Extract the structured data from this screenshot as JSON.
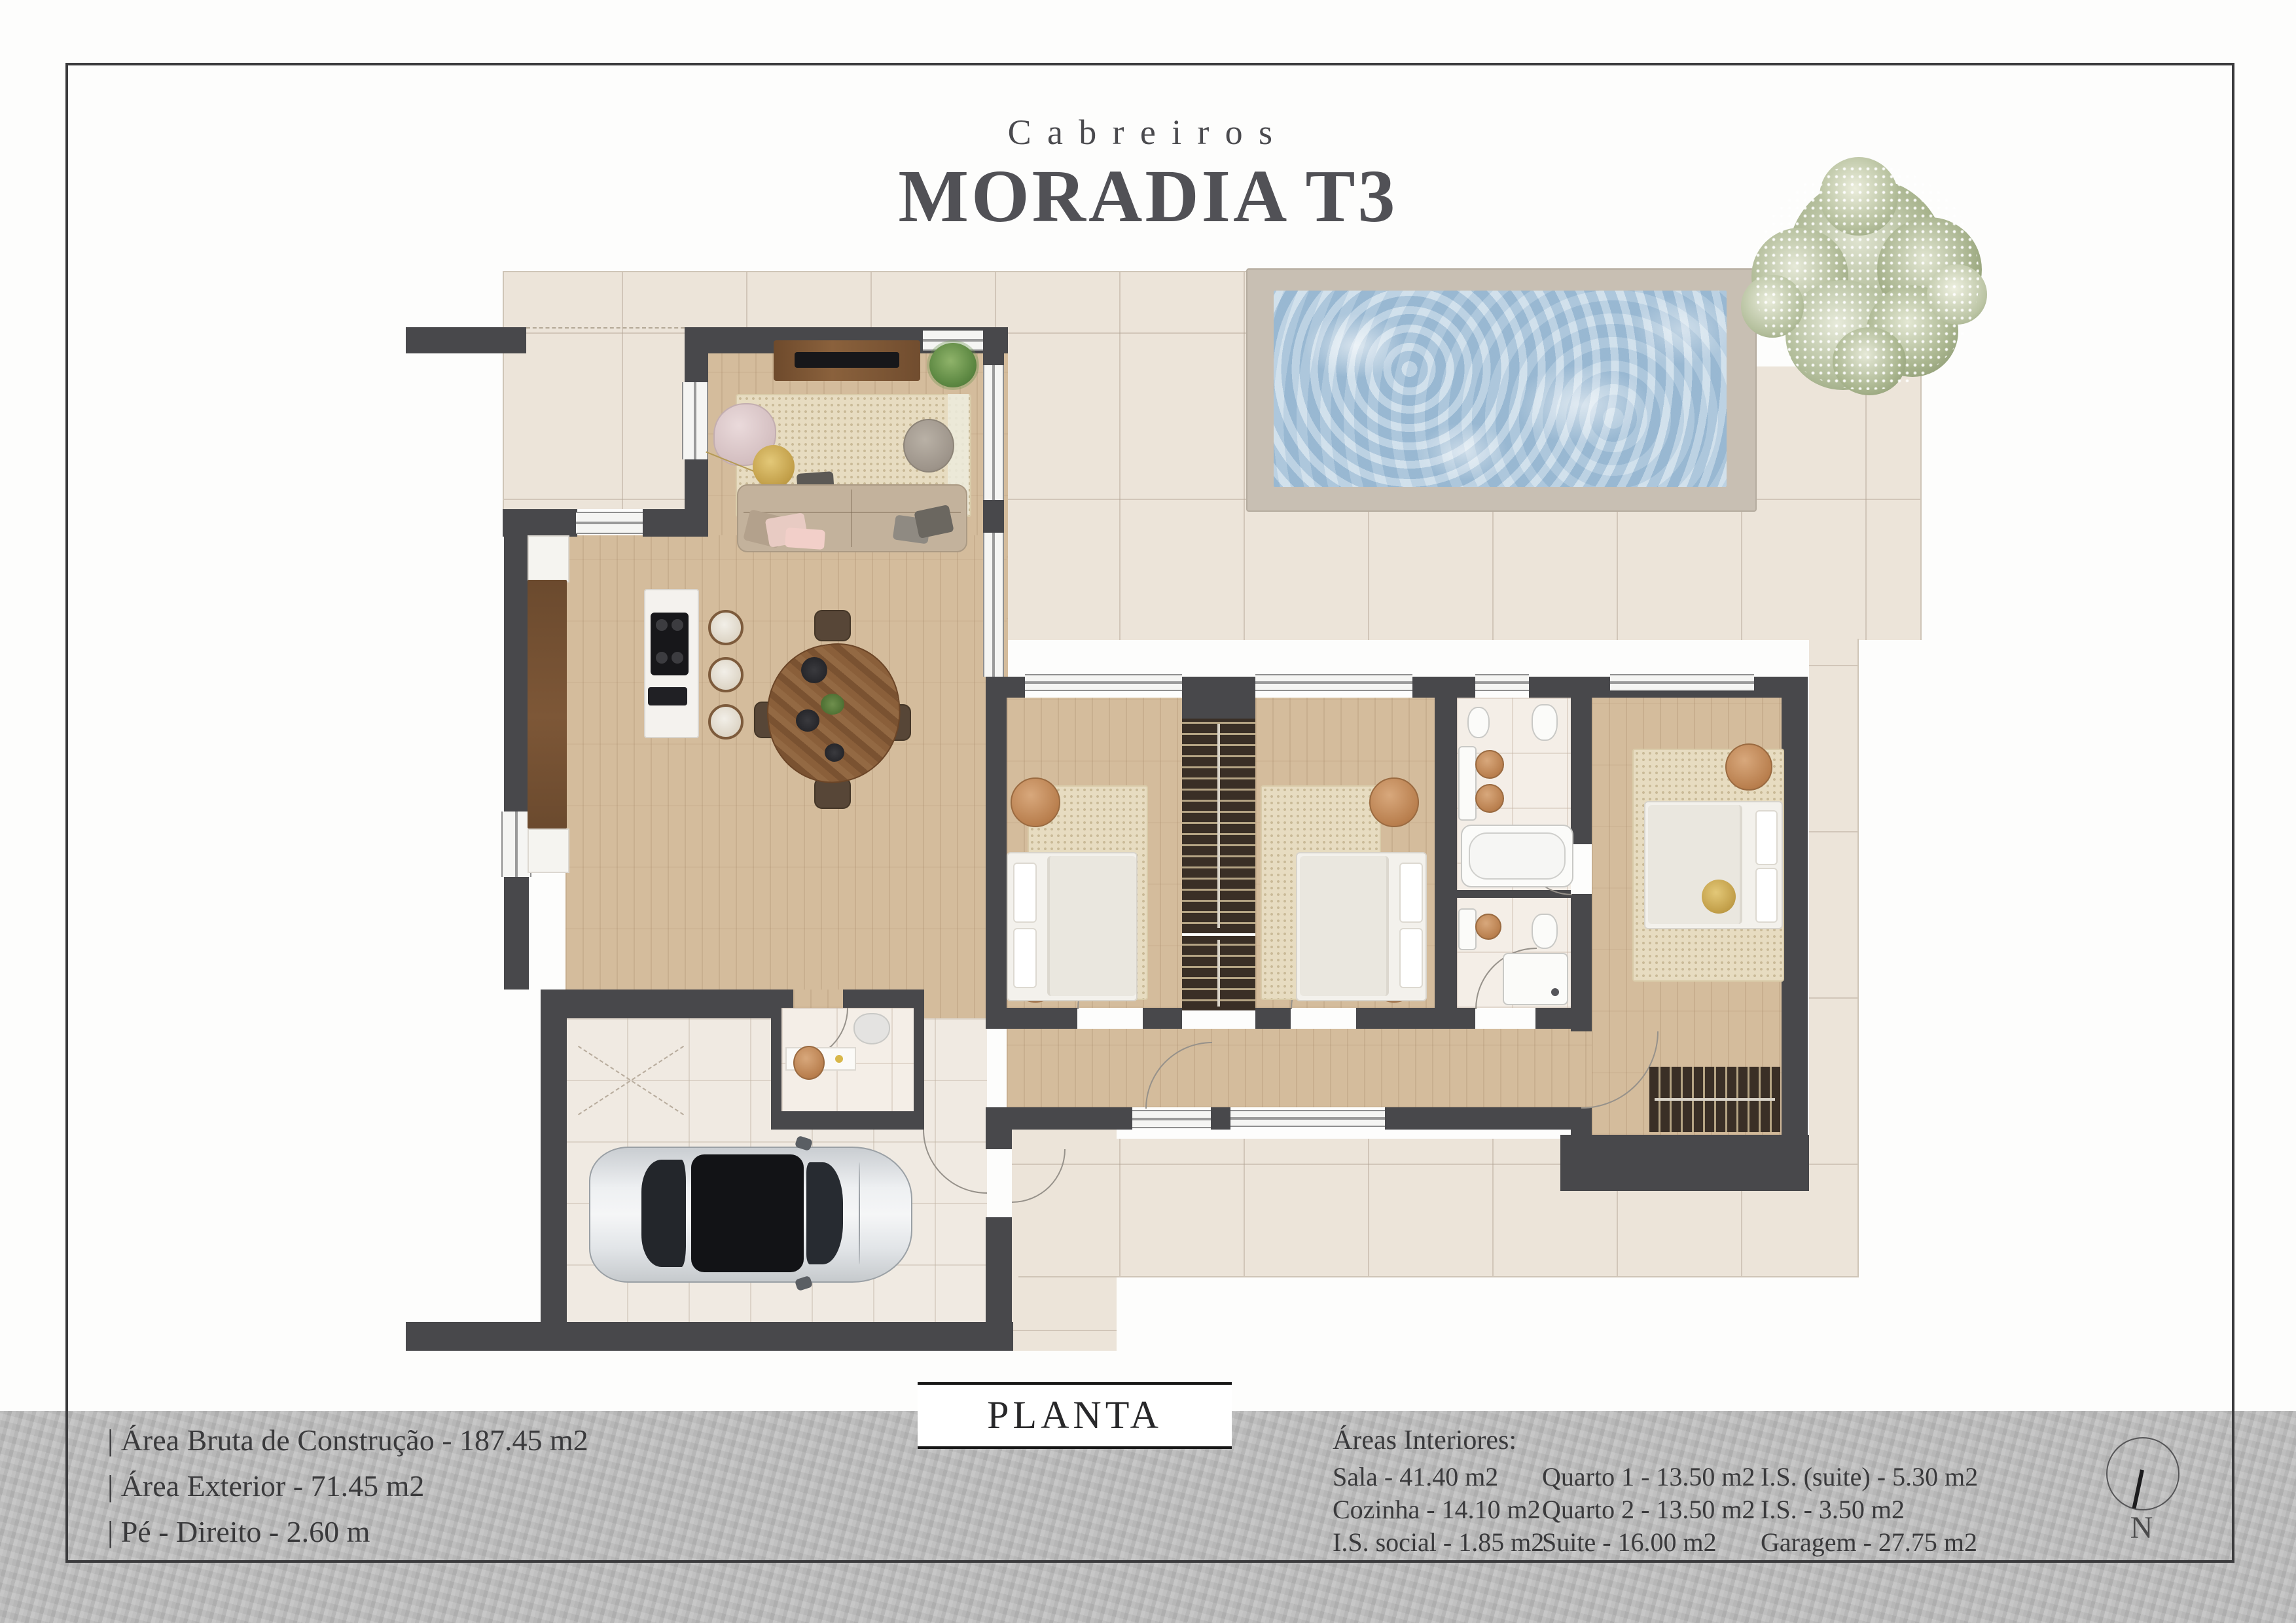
{
  "title": {
    "brand": "Cabreiros",
    "main": "MORADIA T3"
  },
  "plan": {
    "label": "PLANTA",
    "compass_n": "N"
  },
  "footer": {
    "exterior_stats": [
      "| Área Bruta de Construção - 187.45 m2",
      "| Área Exterior - 71.45 m2",
      "| Pé - Direito - 2.60 m"
    ],
    "interior_title": "Áreas Interiores:",
    "interior_col1": [
      "Sala - 41.40 m2",
      "Cozinha - 14.10 m2",
      "I.S. social - 1.85 m2"
    ],
    "interior_col2": [
      "Quarto 1 - 13.50 m2",
      "Quarto 2 - 13.50 m2",
      "Suite - 16.00 m2"
    ],
    "interior_col3": [
      "I.S. (suite) - 5.30 m2",
      "I.S. - 3.50 m2",
      "Garagem - 27.75 m2"
    ]
  },
  "colors": {
    "wall": "#48484b",
    "wood_floor": "#d4bc9c",
    "deck_tile": "#ece4d9",
    "pool_water": "#aec9de",
    "pool_coping": "#c8bfb3",
    "footer_bar": "#bcbcbc",
    "title_text": "#55555a"
  }
}
